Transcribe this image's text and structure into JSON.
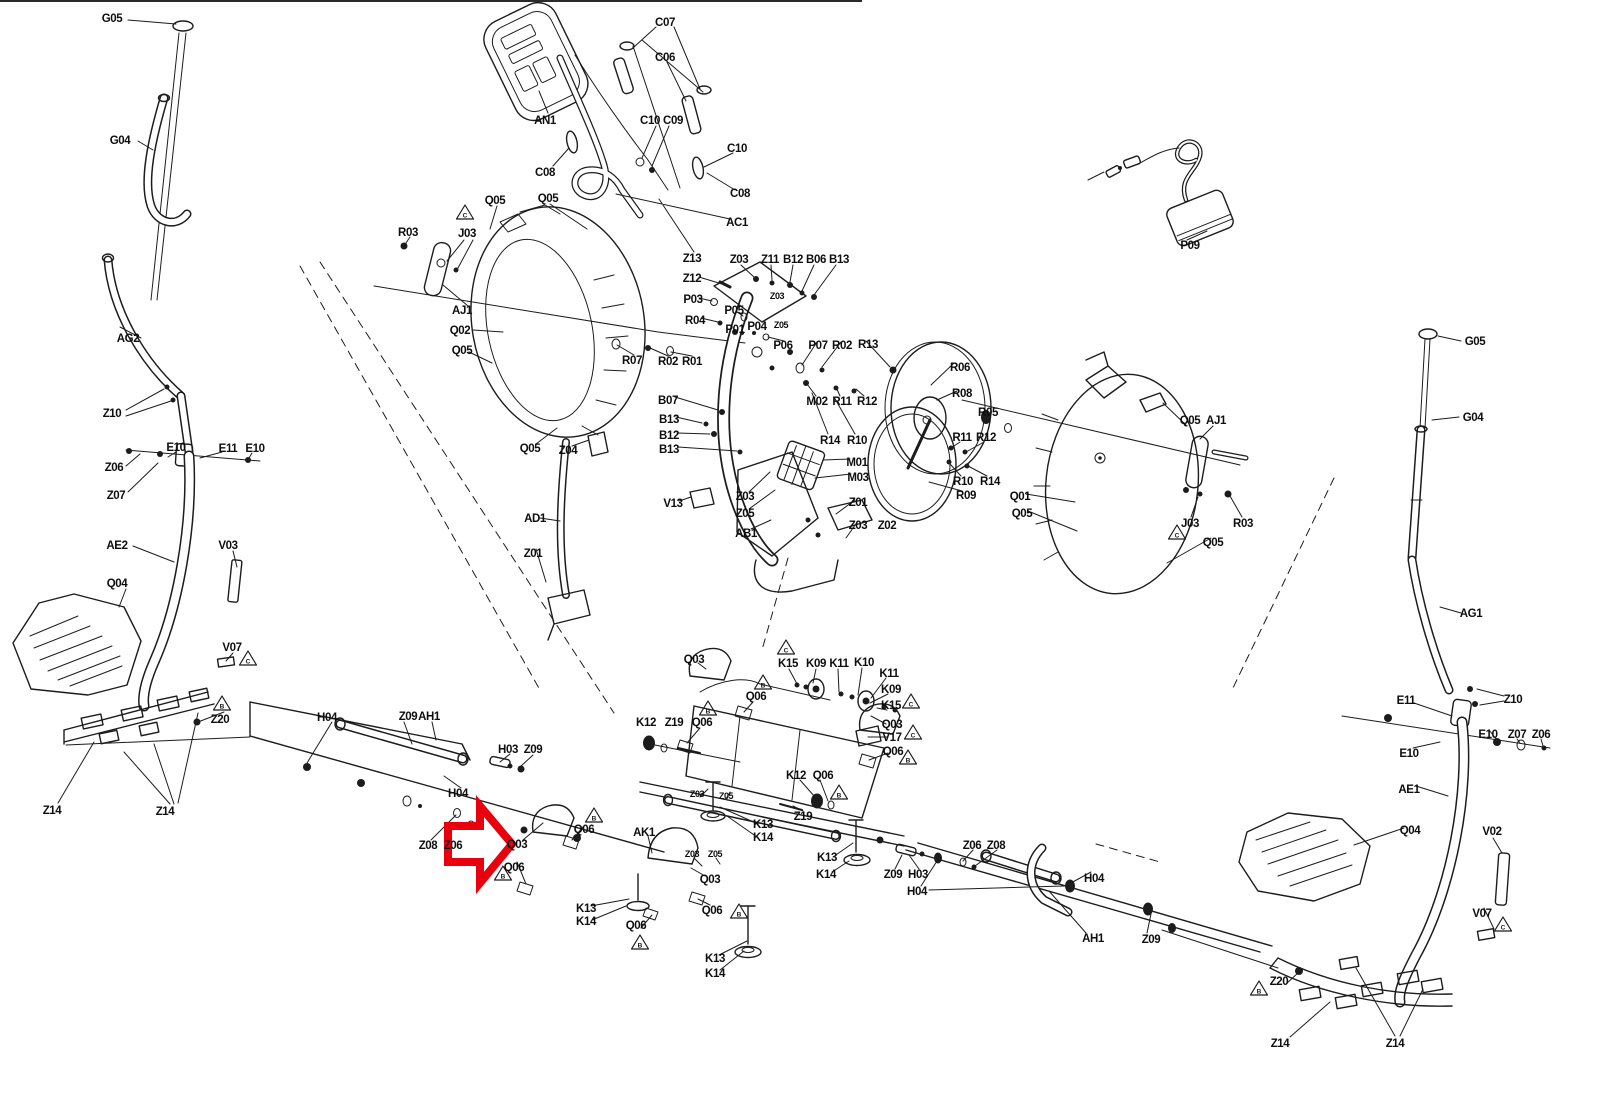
{
  "diagram": {
    "kind": "exploded-parts-diagram",
    "subject": "elliptical-trainer",
    "line_color": "#1c1c1c",
    "background": "#ffffff"
  },
  "highlight": {
    "color": "#e8000d",
    "target_label": "Q03"
  },
  "labels": [
    {
      "t": "G05",
      "x": 112,
      "y": 18
    },
    {
      "t": "G04",
      "x": 120,
      "y": 140
    },
    {
      "t": "AG2",
      "x": 128,
      "y": 338
    },
    {
      "t": "Z10",
      "x": 112,
      "y": 413
    },
    {
      "t": "E10",
      "x": 176,
      "y": 447
    },
    {
      "t": "E11",
      "x": 228,
      "y": 448
    },
    {
      "t": "E10",
      "x": 255,
      "y": 448
    },
    {
      "t": "Z06",
      "x": 114,
      "y": 467
    },
    {
      "t": "Z07",
      "x": 116,
      "y": 495
    },
    {
      "t": "AE2",
      "x": 117,
      "y": 545
    },
    {
      "t": "V03",
      "x": 228,
      "y": 545
    },
    {
      "t": "Q04",
      "x": 117,
      "y": 583
    },
    {
      "t": "V07",
      "x": 232,
      "y": 647
    },
    {
      "t": "Z20",
      "x": 220,
      "y": 719
    },
    {
      "t": "Z14",
      "x": 52,
      "y": 810
    },
    {
      "t": "Z14",
      "x": 165,
      "y": 811
    },
    {
      "t": "C07",
      "x": 665,
      "y": 22
    },
    {
      "t": "C06",
      "x": 665,
      "y": 57
    },
    {
      "t": "AN1",
      "x": 545,
      "y": 120
    },
    {
      "t": "C10",
      "x": 650,
      "y": 120
    },
    {
      "t": "C09",
      "x": 673,
      "y": 120
    },
    {
      "t": "C08",
      "x": 545,
      "y": 172
    },
    {
      "t": "C10",
      "x": 737,
      "y": 148
    },
    {
      "t": "C08",
      "x": 740,
      "y": 193
    },
    {
      "t": "AC1",
      "x": 737,
      "y": 222
    },
    {
      "t": "Q05",
      "x": 495,
      "y": 200
    },
    {
      "t": "Q05",
      "x": 548,
      "y": 198
    },
    {
      "t": "R03",
      "x": 408,
      "y": 232
    },
    {
      "t": "J03",
      "x": 467,
      "y": 233
    },
    {
      "t": "AJ1",
      "x": 462,
      "y": 310
    },
    {
      "t": "Q02",
      "x": 460,
      "y": 330
    },
    {
      "t": "Q05",
      "x": 462,
      "y": 350
    },
    {
      "t": "Z13",
      "x": 692,
      "y": 258
    },
    {
      "t": "Z03",
      "x": 739,
      "y": 259
    },
    {
      "t": "Z11",
      "x": 770,
      "y": 259
    },
    {
      "t": "B12",
      "x": 793,
      "y": 259
    },
    {
      "t": "B06",
      "x": 816,
      "y": 259
    },
    {
      "t": "B13",
      "x": 839,
      "y": 259
    },
    {
      "t": "Z12",
      "x": 692,
      "y": 278
    },
    {
      "t": "P03",
      "x": 693,
      "y": 299
    },
    {
      "t": "P05",
      "x": 734,
      "y": 310
    },
    {
      "t": "R04",
      "x": 695,
      "y": 320
    },
    {
      "t": "P01",
      "x": 735,
      "y": 329
    },
    {
      "t": "P04",
      "x": 757,
      "y": 326
    },
    {
      "t": "Z03",
      "x": 777,
      "y": 295,
      "s": 1
    },
    {
      "t": "Z05",
      "x": 781,
      "y": 324,
      "s": 1
    },
    {
      "t": "R07",
      "x": 632,
      "y": 360
    },
    {
      "t": "R02",
      "x": 668,
      "y": 361
    },
    {
      "t": "R01",
      "x": 692,
      "y": 361
    },
    {
      "t": "P06",
      "x": 783,
      "y": 345
    },
    {
      "t": "P07",
      "x": 818,
      "y": 345
    },
    {
      "t": "R02",
      "x": 842,
      "y": 345
    },
    {
      "t": "R13",
      "x": 868,
      "y": 344
    },
    {
      "t": "M02",
      "x": 817,
      "y": 401
    },
    {
      "t": "R11",
      "x": 842,
      "y": 401
    },
    {
      "t": "R12",
      "x": 867,
      "y": 401
    },
    {
      "t": "R14",
      "x": 830,
      "y": 440
    },
    {
      "t": "R10",
      "x": 857,
      "y": 440
    },
    {
      "t": "M01",
      "x": 857,
      "y": 462
    },
    {
      "t": "M03",
      "x": 858,
      "y": 477
    },
    {
      "t": "B07",
      "x": 668,
      "y": 400
    },
    {
      "t": "B13",
      "x": 669,
      "y": 419
    },
    {
      "t": "B12",
      "x": 669,
      "y": 435
    },
    {
      "t": "B13",
      "x": 669,
      "y": 449
    },
    {
      "t": "Q05",
      "x": 530,
      "y": 448
    },
    {
      "t": "Z04",
      "x": 568,
      "y": 450
    },
    {
      "t": "AD1",
      "x": 535,
      "y": 518
    },
    {
      "t": "Z01",
      "x": 533,
      "y": 553
    },
    {
      "t": "V13",
      "x": 673,
      "y": 503
    },
    {
      "t": "Z03",
      "x": 745,
      "y": 496
    },
    {
      "t": "Z05",
      "x": 745,
      "y": 513
    },
    {
      "t": "AB1",
      "x": 746,
      "y": 533
    },
    {
      "t": "Z01",
      "x": 858,
      "y": 502
    },
    {
      "t": "Z03",
      "x": 858,
      "y": 525
    },
    {
      "t": "Z02",
      "x": 887,
      "y": 525
    },
    {
      "t": "R06",
      "x": 960,
      "y": 367
    },
    {
      "t": "R08",
      "x": 962,
      "y": 393
    },
    {
      "t": "R05",
      "x": 988,
      "y": 412
    },
    {
      "t": "R11",
      "x": 962,
      "y": 437
    },
    {
      "t": "R12",
      "x": 986,
      "y": 437
    },
    {
      "t": "R10",
      "x": 963,
      "y": 481
    },
    {
      "t": "R14",
      "x": 990,
      "y": 481
    },
    {
      "t": "R09",
      "x": 966,
      "y": 495
    },
    {
      "t": "Q01",
      "x": 1020,
      "y": 496
    },
    {
      "t": "Q05",
      "x": 1022,
      "y": 513
    },
    {
      "t": "P09",
      "x": 1190,
      "y": 245
    },
    {
      "t": "Q05",
      "x": 1190,
      "y": 420
    },
    {
      "t": "AJ1",
      "x": 1216,
      "y": 420
    },
    {
      "t": "J03",
      "x": 1190,
      "y": 523
    },
    {
      "t": "R03",
      "x": 1243,
      "y": 523
    },
    {
      "t": "Q05",
      "x": 1213,
      "y": 542
    },
    {
      "t": "G05",
      "x": 1475,
      "y": 341
    },
    {
      "t": "G04",
      "x": 1473,
      "y": 417
    },
    {
      "t": "AG1",
      "x": 1471,
      "y": 613
    },
    {
      "t": "Z10",
      "x": 1513,
      "y": 699
    },
    {
      "t": "E11",
      "x": 1406,
      "y": 700
    },
    {
      "t": "E10",
      "x": 1488,
      "y": 734
    },
    {
      "t": "Z07",
      "x": 1517,
      "y": 734
    },
    {
      "t": "Z06",
      "x": 1541,
      "y": 734
    },
    {
      "t": "E10",
      "x": 1409,
      "y": 753
    },
    {
      "t": "AE1",
      "x": 1409,
      "y": 789
    },
    {
      "t": "Q04",
      "x": 1410,
      "y": 830
    },
    {
      "t": "V02",
      "x": 1492,
      "y": 831
    },
    {
      "t": "V07",
      "x": 1482,
      "y": 913
    },
    {
      "t": "Z20",
      "x": 1279,
      "y": 981
    },
    {
      "t": "Z14",
      "x": 1280,
      "y": 1043
    },
    {
      "t": "Z14",
      "x": 1395,
      "y": 1043
    },
    {
      "t": "H04",
      "x": 327,
      "y": 717
    },
    {
      "t": "Z09",
      "x": 408,
      "y": 716
    },
    {
      "t": "AH1",
      "x": 429,
      "y": 716
    },
    {
      "t": "H03",
      "x": 508,
      "y": 749
    },
    {
      "t": "Z09",
      "x": 533,
      "y": 749
    },
    {
      "t": "H04",
      "x": 458,
      "y": 793
    },
    {
      "t": "Z08",
      "x": 428,
      "y": 845
    },
    {
      "t": "Z06",
      "x": 453,
      "y": 845
    },
    {
      "t": "Q03",
      "x": 517,
      "y": 844
    },
    {
      "t": "Q06",
      "x": 514,
      "y": 867
    },
    {
      "t": "Q06",
      "x": 584,
      "y": 829
    },
    {
      "t": "Q03",
      "x": 694,
      "y": 659
    },
    {
      "t": "K15",
      "x": 788,
      "y": 663
    },
    {
      "t": "K09",
      "x": 816,
      "y": 663
    },
    {
      "t": "K11",
      "x": 839,
      "y": 663
    },
    {
      "t": "K10",
      "x": 864,
      "y": 662
    },
    {
      "t": "K11",
      "x": 889,
      "y": 673
    },
    {
      "t": "K09",
      "x": 891,
      "y": 689
    },
    {
      "t": "K15",
      "x": 891,
      "y": 705
    },
    {
      "t": "Q06",
      "x": 756,
      "y": 696
    },
    {
      "t": "K12",
      "x": 646,
      "y": 722
    },
    {
      "t": "Z19",
      "x": 674,
      "y": 722
    },
    {
      "t": "Q06",
      "x": 702,
      "y": 722
    },
    {
      "t": "Q03",
      "x": 892,
      "y": 724
    },
    {
      "t": "V17",
      "x": 892,
      "y": 737
    },
    {
      "t": "Q06",
      "x": 893,
      "y": 751
    },
    {
      "t": "K12",
      "x": 796,
      "y": 775
    },
    {
      "t": "Q06",
      "x": 823,
      "y": 775
    },
    {
      "t": "Z03",
      "x": 697,
      "y": 793,
      "s": 1
    },
    {
      "t": "Z05",
      "x": 726,
      "y": 795,
      "s": 1
    },
    {
      "t": "Z19",
      "x": 803,
      "y": 816
    },
    {
      "t": "K13",
      "x": 763,
      "y": 824
    },
    {
      "t": "K14",
      "x": 763,
      "y": 837
    },
    {
      "t": "AK1",
      "x": 644,
      "y": 832
    },
    {
      "t": "Z03",
      "x": 692,
      "y": 853,
      "s": 1
    },
    {
      "t": "Z05",
      "x": 715,
      "y": 853,
      "s": 1
    },
    {
      "t": "Q03",
      "x": 710,
      "y": 879
    },
    {
      "t": "Q06",
      "x": 712,
      "y": 910
    },
    {
      "t": "Q06",
      "x": 636,
      "y": 925
    },
    {
      "t": "K13",
      "x": 715,
      "y": 958
    },
    {
      "t": "K14",
      "x": 715,
      "y": 973
    },
    {
      "t": "K13",
      "x": 586,
      "y": 908
    },
    {
      "t": "K14",
      "x": 586,
      "y": 921
    },
    {
      "t": "K13",
      "x": 827,
      "y": 857
    },
    {
      "t": "K14",
      "x": 826,
      "y": 874
    },
    {
      "t": "Z09",
      "x": 893,
      "y": 874
    },
    {
      "t": "H03",
      "x": 918,
      "y": 874
    },
    {
      "t": "H04",
      "x": 917,
      "y": 891
    },
    {
      "t": "Z06",
      "x": 972,
      "y": 845
    },
    {
      "t": "Z08",
      "x": 996,
      "y": 845
    },
    {
      "t": "H04",
      "x": 1094,
      "y": 878
    },
    {
      "t": "AH1",
      "x": 1093,
      "y": 938
    },
    {
      "t": "Z09",
      "x": 1151,
      "y": 939
    }
  ],
  "warning_triangles": [
    {
      "x": 465,
      "y": 213,
      "m": "C"
    },
    {
      "x": 1177,
      "y": 533,
      "m": "C"
    },
    {
      "x": 248,
      "y": 659,
      "m": "C"
    },
    {
      "x": 222,
      "y": 704,
      "m": "B"
    },
    {
      "x": 1503,
      "y": 925,
      "m": "C"
    },
    {
      "x": 1259,
      "y": 989,
      "m": "B"
    },
    {
      "x": 786,
      "y": 648,
      "m": "C"
    },
    {
      "x": 911,
      "y": 702,
      "m": "C"
    },
    {
      "x": 763,
      "y": 683,
      "m": "B"
    },
    {
      "x": 708,
      "y": 709,
      "m": "B"
    },
    {
      "x": 913,
      "y": 733,
      "m": "C"
    },
    {
      "x": 908,
      "y": 758,
      "m": "B"
    },
    {
      "x": 839,
      "y": 793,
      "m": "B"
    },
    {
      "x": 594,
      "y": 816,
      "m": "B"
    },
    {
      "x": 503,
      "y": 874,
      "m": "B"
    },
    {
      "x": 739,
      "y": 912,
      "m": "B"
    },
    {
      "x": 640,
      "y": 943,
      "m": "B"
    }
  ]
}
